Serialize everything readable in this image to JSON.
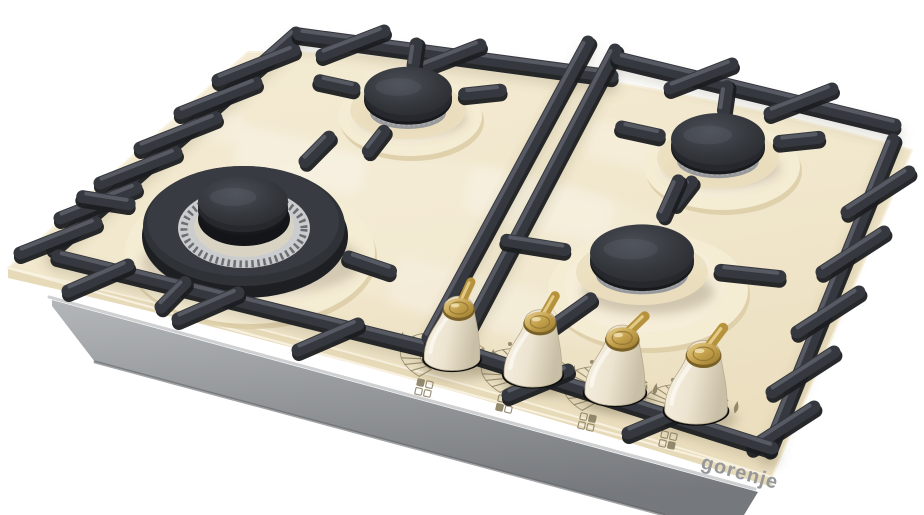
{
  "meta": {
    "description": "Product render of a Gorenje 4-burner gas hob: ivory glass surface, black cast-iron pan supports, aluminum burner rings, cream bell-shaped knobs with brass levers",
    "background": "#ffffff"
  },
  "brand": {
    "logo_text": "gorenje",
    "logo_color": "#95979b"
  },
  "colors": {
    "glass": "#f2e8ce",
    "glass_light": "#f7efdc",
    "glass_edge": "#e7dab9",
    "glass_edge_dark": "#d8c9a4",
    "mound": "#f5ecd4",
    "mound_rim": "#dccda6",
    "tray_light": "#b9bcbe",
    "tray_dark": "#7c7f83",
    "tray_lip": "#caccce",
    "grate": "#35383e",
    "grate_shadow": "#1b1d20",
    "grate_highlight": "#5d616a",
    "cap_dark": "#17191c",
    "cap_mid": "#26282d",
    "ring_silver": "#d9dadb",
    "ring_silver_dark": "#97999c",
    "brass": "#b6923c",
    "brass_light": "#e7cf8e",
    "brass_dark": "#7a6128",
    "knob_body": "#f1e9d6",
    "knob_shadow": "#0c0c0c",
    "print": "#8f8568",
    "soft_shadow": "#6b5f45"
  },
  "burners": [
    {
      "id": "rear-left",
      "size": "medium",
      "cap": "black textured",
      "ring": "aluminum"
    },
    {
      "id": "front-left",
      "size": "large-wok",
      "cap": "black textured",
      "ring": "aluminum-toothed double crown"
    },
    {
      "id": "rear-right",
      "size": "medium",
      "cap": "black textured",
      "ring": "aluminum"
    },
    {
      "id": "front-right",
      "size": "medium-large",
      "cap": "black textured",
      "ring": "aluminum"
    }
  ],
  "knobs": [
    {
      "id": "knob-1",
      "controls": "rear-left burner",
      "filled_square": "tl",
      "style": "cream bell with brass cap and lever"
    },
    {
      "id": "knob-2",
      "controls": "front-left burner",
      "filled_square": "bl",
      "style": "cream bell with brass cap and lever"
    },
    {
      "id": "knob-3",
      "controls": "rear-right burner",
      "filled_square": "tr",
      "style": "cream bell with brass cap and lever"
    },
    {
      "id": "knob-4",
      "controls": "front-right burner",
      "filled_square": "br",
      "style": "cream bell with brass cap and lever"
    }
  ],
  "dial_print": {
    "color": "#8f8568",
    "symbols": [
      "flame-large-icon",
      "flame-small-icon",
      "off-dot-icon",
      "burner-position-icon"
    ]
  }
}
